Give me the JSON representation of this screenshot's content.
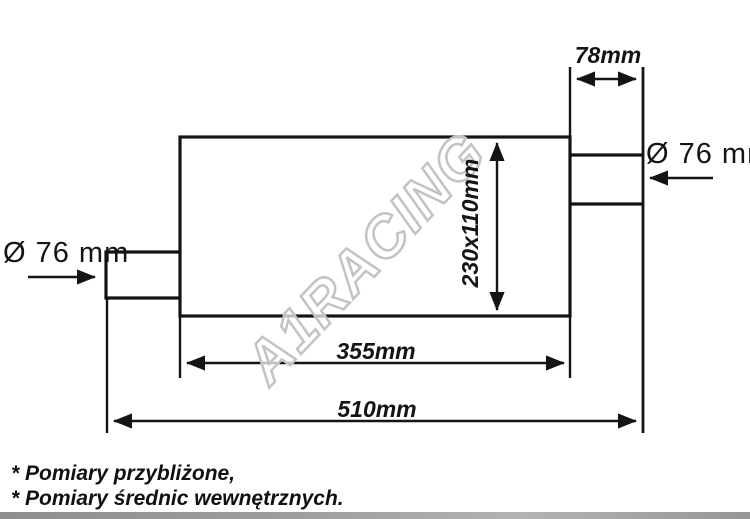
{
  "diagram": {
    "title_none": "",
    "watermark": "A1RACING",
    "dimensions": {
      "outlet_pipe_length": "78mm",
      "outlet_diameter": "Ø 76 mm",
      "inlet_diameter": "Ø 76 mm",
      "body_cross_section": "230x110mm",
      "body_length": "355mm",
      "total_length": "510mm"
    },
    "notes": [
      "* Pomiary przybliżone,",
      "* Pomiary średnic wewnętrznych."
    ],
    "colors": {
      "line": "#141414",
      "watermark_outline": "#c3c3c3",
      "background": "#ffffff",
      "bottom_strip": "#9a9a9a"
    }
  }
}
